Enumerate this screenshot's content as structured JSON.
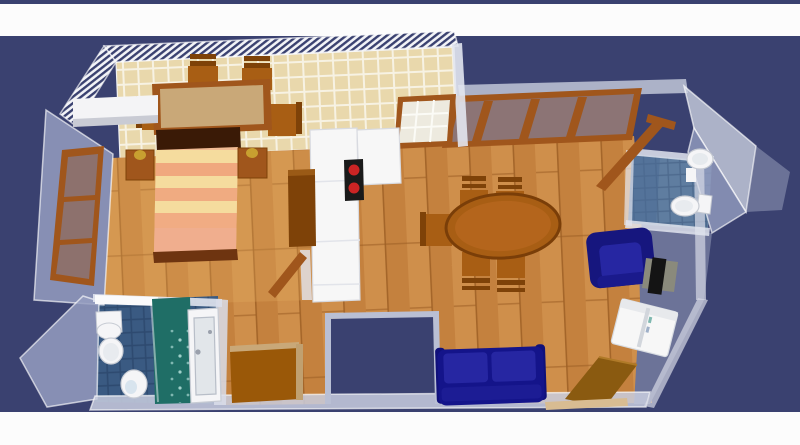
{
  "app": {
    "view_type": "3d-aerial-floorplan-render",
    "ui_text": [],
    "top_band": "white",
    "bottom_band": "white"
  },
  "colors": {
    "bgNavy": "#3A4170",
    "bandWhite": "#FCFCFC",
    "wallLavender": "#959DC0",
    "wallLight": "#C9CEDF",
    "wallPale": "#E2E5EF",
    "hatchNavy": "#3A4170",
    "hatchBg": "#F2F3F7",
    "tileBeige": "#E9D8AC",
    "tileGrout": "#F7F2E3",
    "woodBase": "#C4813E",
    "woodLight": "#D89A55",
    "woodDark": "#9C5E24",
    "bedroomTint": "#E8B066",
    "frameBrown": "#A0561C",
    "darkBrown": "#7E4208",
    "furnBrown": "#A85E14",
    "tableTan": "#C9A878",
    "headboard": "#3A1A06",
    "footRail": "#6E3410",
    "mattressBase": "#F2BC94",
    "stripeYellow": "#F5DC9E",
    "stripeSalmon": "#F0A87E",
    "pinkBlanket": "#F0AE8E",
    "lampGold": "#C8A030",
    "fixtureWhite": "#F5F5F7",
    "applianceWhite": "#F7F7F7",
    "cooktopBlack": "#1A1A1A",
    "burnerRed": "#CC2424",
    "sofaNavy": "#14148A",
    "cushionNavy": "#2626A2",
    "armNavy": "#10107A",
    "tealShower": "#1F6E66",
    "bathTile": "#3A5A82",
    "bathGrout": "#2E4A70",
    "wcTile": "#5F7DA0",
    "wcGrout": "#4E6A8E",
    "wcTileLight": "#4A6A94",
    "terraceGray": "#6C7398",
    "tvBlack": "#141414",
    "standGray": "#8A8A7C",
    "panelBrown": "#8A5A10",
    "cabinetBrown": "#9A5808",
    "stripTan": "#D8BC92",
    "glassBlue": "#7E88B0"
  },
  "scene": {
    "rooms": [
      {
        "name": "kitchen-dining",
        "floor": "beige-tile",
        "furniture": [
          {
            "name": "dining-table",
            "count": 1
          },
          {
            "name": "chair",
            "count": 4
          },
          {
            "name": "kitchen-counter",
            "count": 1
          },
          {
            "name": "cooktop",
            "count": 1
          },
          {
            "name": "fridge-cabinet-column",
            "count": 1
          },
          {
            "name": "grid-pane-window",
            "count": 1
          }
        ]
      },
      {
        "name": "bedroom",
        "floor": "wood",
        "furniture": [
          {
            "name": "double-bed-striped",
            "count": 1
          },
          {
            "name": "nightstand",
            "count": 2
          },
          {
            "name": "table-lamp",
            "count": 2
          },
          {
            "name": "wardrobe",
            "count": 1
          },
          {
            "name": "three-pane-window",
            "count": 1
          },
          {
            "name": "wall-shelf",
            "count": 1
          }
        ]
      },
      {
        "name": "living-room",
        "floor": "wood",
        "furniture": [
          {
            "name": "oval-dining-table",
            "count": 1
          },
          {
            "name": "chair",
            "count": 5
          },
          {
            "name": "sofa-navy",
            "count": 1
          },
          {
            "name": "armchair-navy",
            "count": 1
          },
          {
            "name": "tv",
            "count": 1
          },
          {
            "name": "tv-stand",
            "count": 1
          },
          {
            "name": "washing-machine",
            "count": 1
          },
          {
            "name": "leaning-door-panel",
            "count": 1
          },
          {
            "name": "ribbon-window",
            "count": 1
          }
        ]
      },
      {
        "name": "bathroom",
        "floor": "dark-blue-tile",
        "furniture": [
          {
            "name": "bathtub",
            "count": 1
          },
          {
            "name": "shower-teal",
            "count": 1
          },
          {
            "name": "toilet",
            "count": 1
          },
          {
            "name": "bidet",
            "count": 1
          },
          {
            "name": "wall-sink",
            "count": 1
          }
        ]
      },
      {
        "name": "wc",
        "floor": "blue-tile",
        "furniture": [
          {
            "name": "pedestal-sink",
            "count": 1
          },
          {
            "name": "toilet",
            "count": 1
          },
          {
            "name": "open-door",
            "count": 1
          }
        ]
      },
      {
        "name": "hallway",
        "floor": "wood",
        "furniture": [
          {
            "name": "cabinet",
            "count": 1
          },
          {
            "name": "open-door",
            "count": 1
          },
          {
            "name": "entrance-notch",
            "count": 1
          }
        ]
      }
    ]
  }
}
